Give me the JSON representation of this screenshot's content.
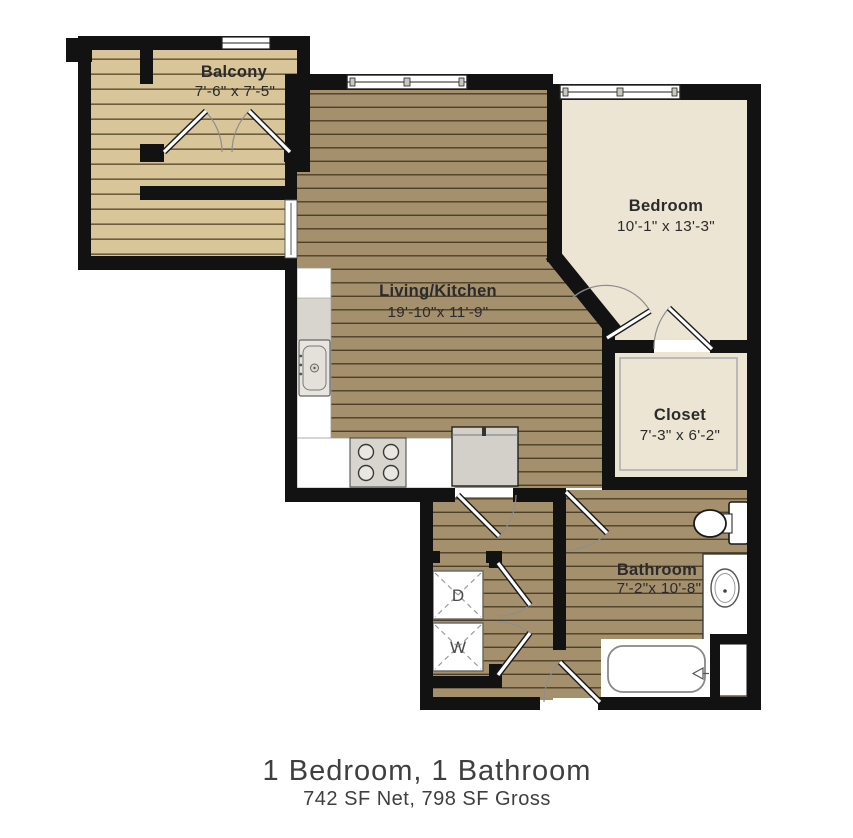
{
  "plan": {
    "balcony": {
      "name": "Balcony",
      "dims": "7'-6\" x 7'-5\""
    },
    "bedroom": {
      "name": "Bedroom",
      "dims": "10'-1\" x 13'-3\""
    },
    "living": {
      "name": "Living/Kitchen",
      "dims": "19'-10\"x 11'-9\""
    },
    "closet": {
      "name": "Closet",
      "dims": "7'-3\" x 6'-2\""
    },
    "bathroom": {
      "name": "Bathroom",
      "dims": "7'-2\"x 10'-8\""
    },
    "laundry": {
      "dryer": "D",
      "washer": "W"
    }
  },
  "caption": {
    "title": "1 Bedroom, 1 Bathroom",
    "subtitle": "742 SF Net, 798 SF Gross"
  },
  "colors": {
    "wall": "#121212",
    "deck": "#d8c59a",
    "deck_line": "#6d5d3c",
    "wood_floor": "#a5906d",
    "wood_line": "#4e4028",
    "room_cream": "#ece5d3"
  }
}
